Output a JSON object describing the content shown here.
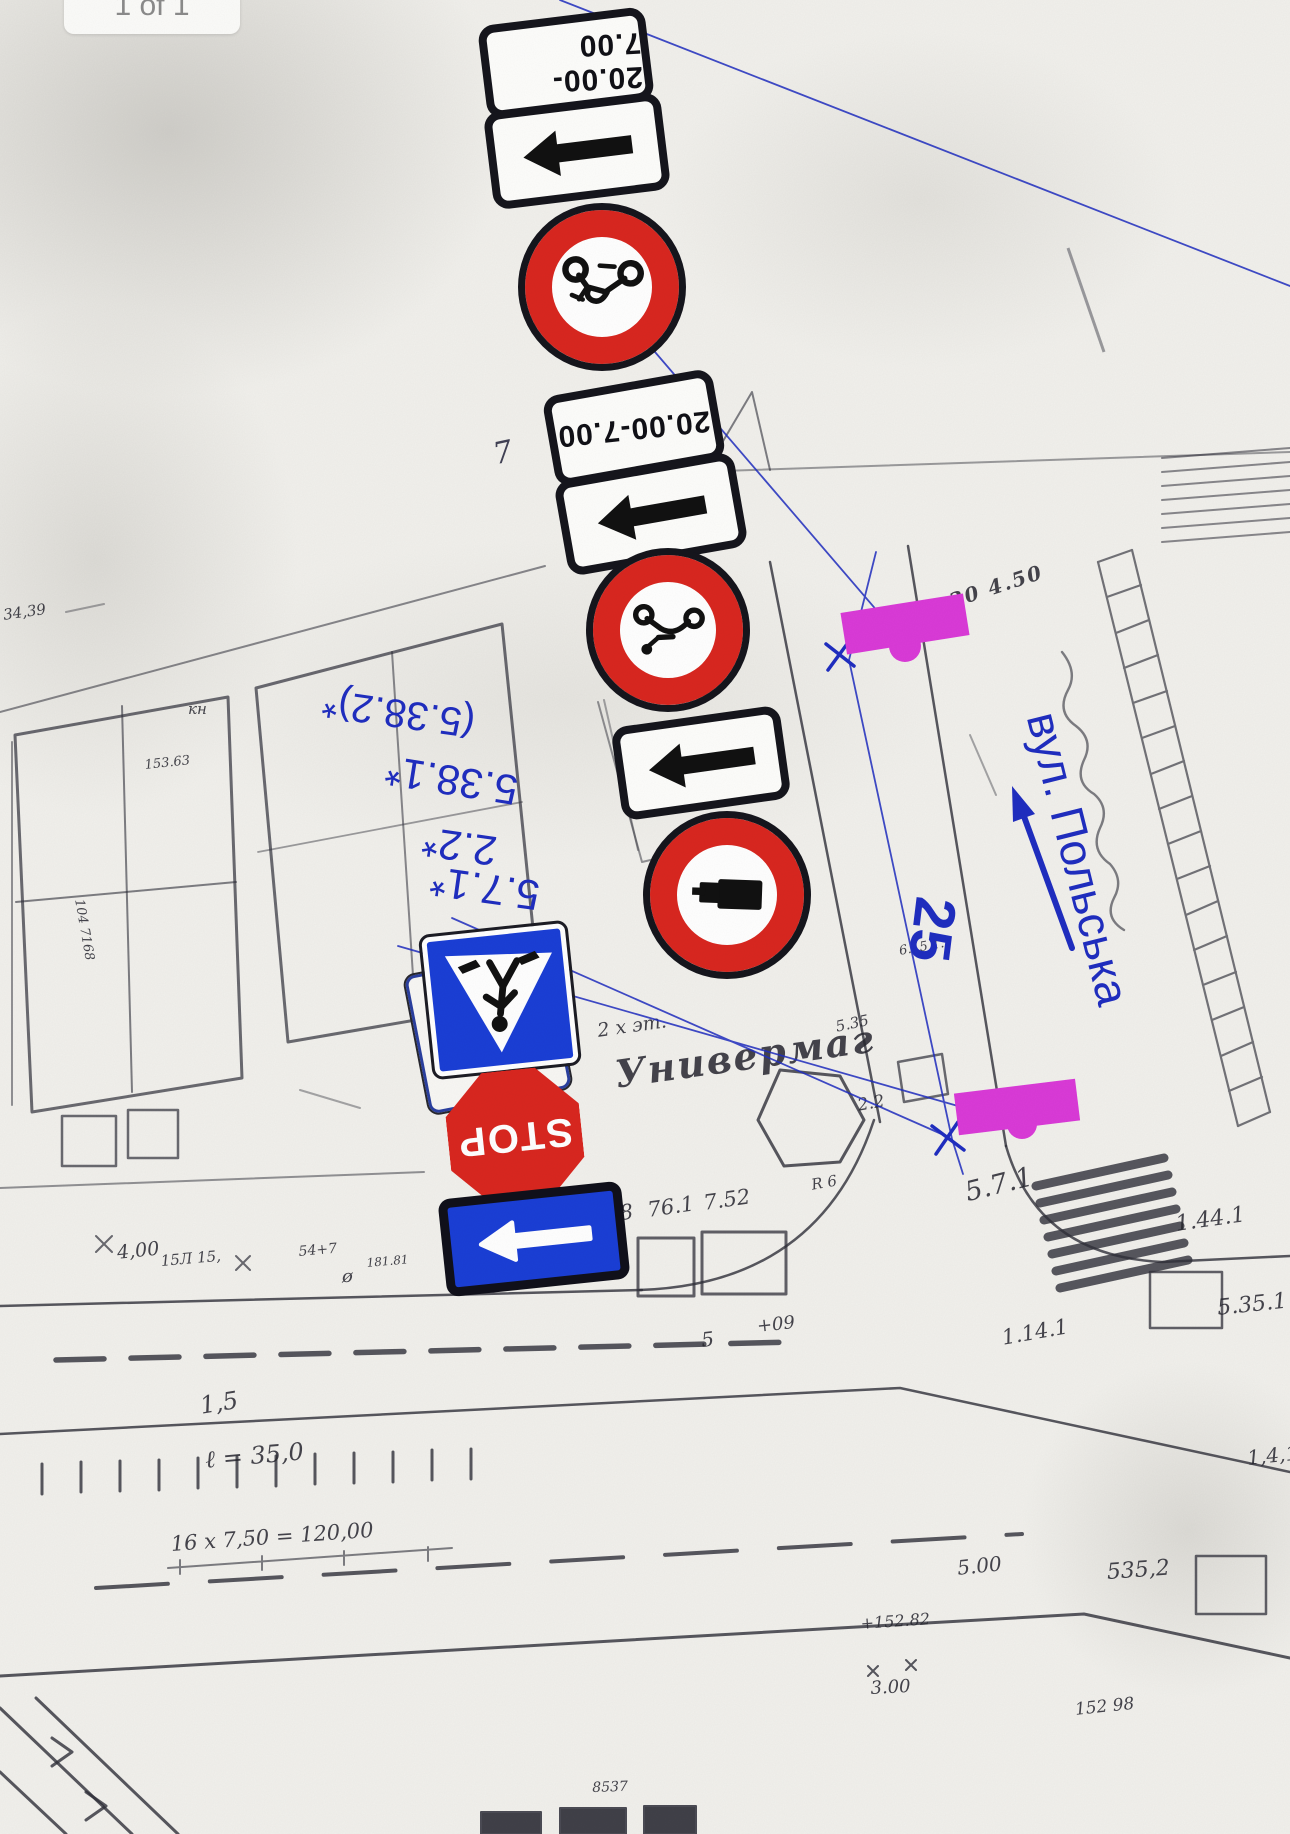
{
  "viewer": {
    "page_indicator": "1 of 1"
  },
  "scheme": {
    "accent_blue": "#1f2dc0",
    "marker_magenta": "#da3ad8",
    "sign_red": "#d9261f",
    "sign_blue": "#1a3ed6",
    "time_plate_label": "20.00-7.00",
    "stop_label": "STOP",
    "sign_codes": [
      "(5.38.2)*",
      "5.38.1*",
      "2.2*",
      "5.7.1*"
    ],
    "street_name": "вул. Польська",
    "distance_label": "25"
  },
  "map_labels": [
    {
      "text": "Универмаг"
    },
    {
      "text": "2 х эт."
    },
    {
      "text": "5,98"
    },
    {
      "text": "76.1"
    },
    {
      "text": "7.52"
    },
    {
      "text": "5.7.1"
    },
    {
      "text": "1.44.1"
    },
    {
      "text": "5.35.1"
    },
    {
      "text": "1.14.1"
    },
    {
      "text": "1,4,1"
    },
    {
      "text": "535,2"
    },
    {
      "text": "5.00"
    },
    {
      "text": "+152.82"
    },
    {
      "text": "152 98"
    },
    {
      "text": "3.00"
    },
    {
      "text": "8537"
    },
    {
      "text": "16 х 7,50 = 120,00"
    },
    {
      "text": "ℓ = 35,0"
    },
    {
      "text": "1,5"
    },
    {
      "text": "4,00"
    },
    {
      "text": "15Л 15,"
    },
    {
      "text": "54+7"
    },
    {
      "text": "181.81"
    },
    {
      "text": "ø"
    },
    {
      "text": "34,39"
    },
    {
      "text": "153.63"
    },
    {
      "text": "кн"
    },
    {
      "text": "104 7168"
    },
    {
      "text": "30 4.50"
    },
    {
      "text": "6.15 1."
    },
    {
      "text": "5.35"
    },
    {
      "text": "2.2"
    },
    {
      "text": "R 6"
    },
    {
      "text": "+09"
    },
    {
      "text": "5"
    },
    {
      "text": "7"
    }
  ]
}
